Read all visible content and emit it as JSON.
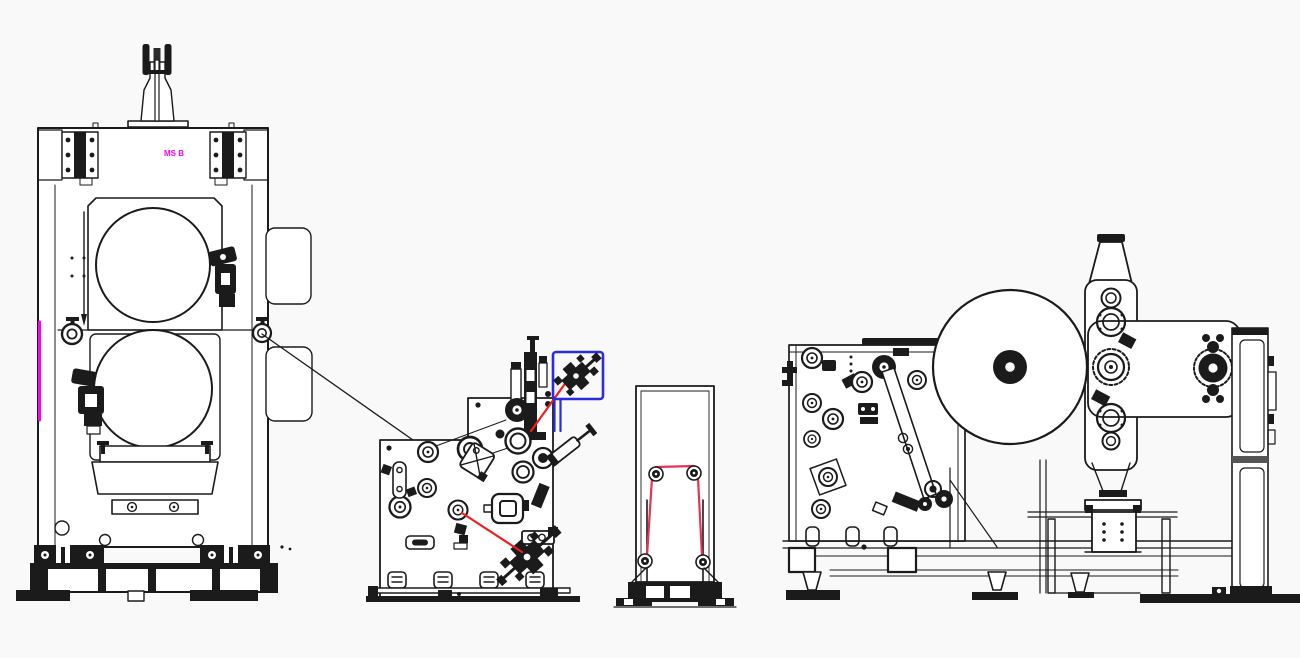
{
  "canvas": {
    "width": 1300,
    "height": 658,
    "background": "#f9f9f9"
  },
  "colors": {
    "ink": "#1b1b1b",
    "red": "#f21d1d",
    "pink_red": "#e93156",
    "blue": "#2b2bdf",
    "magenta": "#ff00f2"
  },
  "label": {
    "part_tag": "MS B"
  },
  "machines": {
    "mill": {
      "name": "two-roll-mill-stand"
    },
    "coater": {
      "name": "coating-head-unit"
    },
    "stand": {
      "name": "web-guide-stand"
    },
    "winder": {
      "name": "turret-winder"
    }
  },
  "highlight": {
    "target": "knife-holder",
    "shape": "rounded-box"
  }
}
